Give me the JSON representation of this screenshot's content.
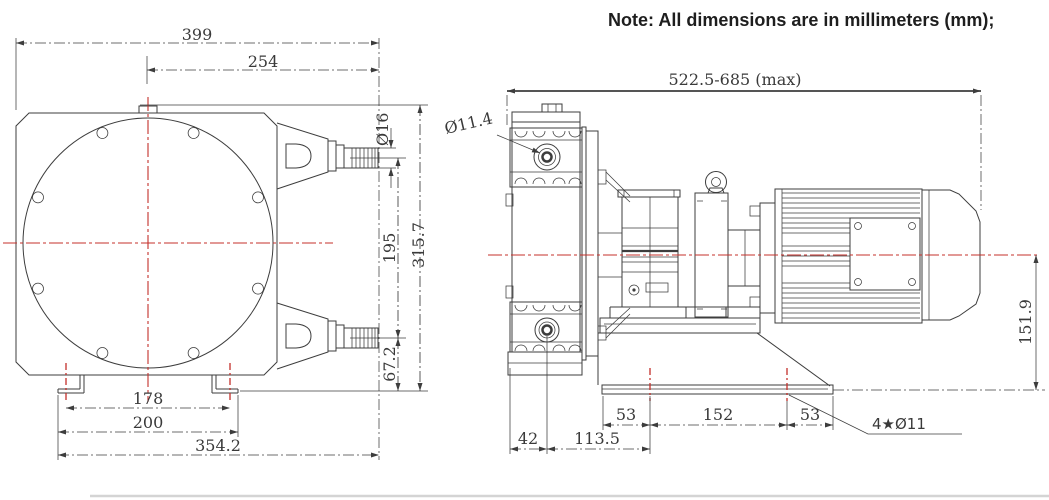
{
  "note": {
    "text": "Note: All dimensions are in millimeters (mm);"
  },
  "front_view": {
    "dims": {
      "overall_width": "399",
      "center_to_port_end": "254",
      "port_od": "Ø16",
      "port_spacing": "195",
      "overall_height": "315.7",
      "port_to_base": "67.2",
      "foot_hole_pitch": "178",
      "foot_width": "200",
      "overall_base_width": "354.2"
    }
  },
  "side_view": {
    "dims": {
      "overall_length": "522.5-685 (max)",
      "port_bore": "Ø11.4",
      "head_edge_to_port": "42",
      "port_to_first_hole": "113.5",
      "base_hole_left": "53",
      "base_hole_pitch": "152",
      "base_hole_right": "53",
      "center_height": "151.9",
      "mount_holes": "4★Ø11"
    }
  },
  "colors": {
    "line": "#3d3d3d",
    "centerline": "#c4302b",
    "dim_text": "#3a3a3a",
    "note_text": "#1e1e1e"
  }
}
